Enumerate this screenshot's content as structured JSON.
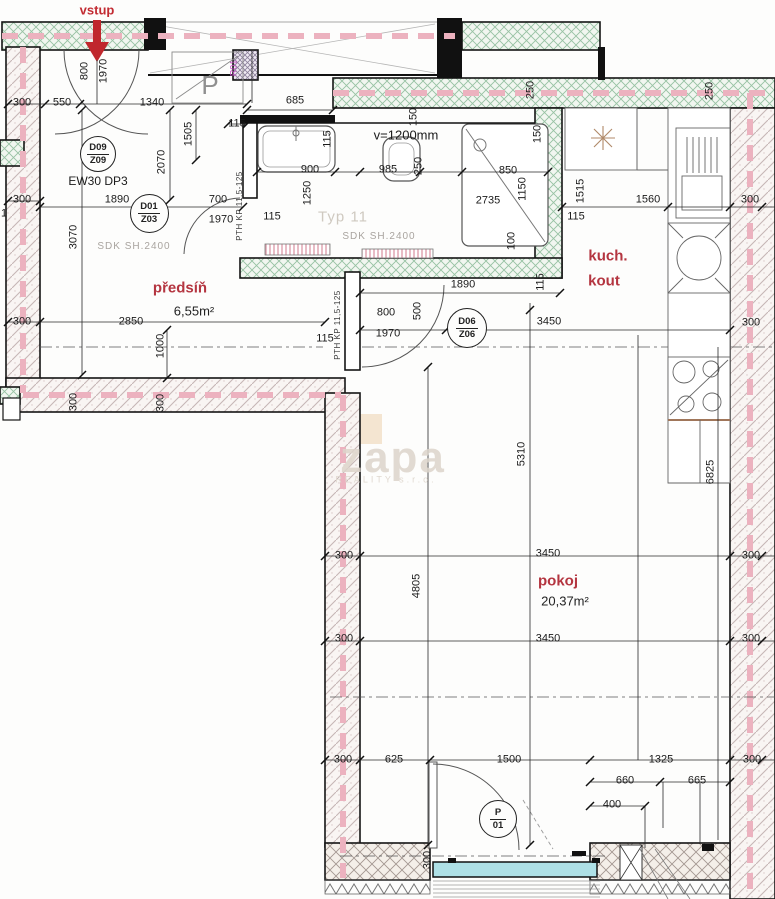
{
  "drawing_labels": {
    "entrance": "vstup",
    "watermark": "zapa",
    "watermark_sub": "REALITY s.r.o."
  },
  "rooms": [
    {
      "name": "předsíň",
      "area": "6,55m²"
    },
    {
      "name": "koupelna",
      "area": "3,22m²"
    },
    {
      "name": "kuch. kout",
      "area": ""
    },
    {
      "name": "pokoj",
      "area": "20,37m²"
    }
  ],
  "door_tags": [
    {
      "line1": "D09",
      "line2": "Z09",
      "x": 97,
      "y": 153,
      "d": 34
    },
    {
      "line1": "D01",
      "line2": "Z03",
      "x": 148,
      "y": 212,
      "d": 37
    },
    {
      "line1": "D06",
      "line2": "Z06",
      "x": 466,
      "y": 327,
      "d": 38
    },
    {
      "line1": "P",
      "line2": "01",
      "x": 497,
      "y": 818,
      "d": 36
    }
  ],
  "fixtures": [
    "bathtub",
    "toilet",
    "shower",
    "kitchen-sink",
    "dish-rack",
    "stove",
    "wardrobe",
    "radiator",
    "balcony-door",
    "entrance-arrow"
  ],
  "colors": {
    "room_label_red": "#b43540",
    "entrance_red": "#c22b32",
    "pink_dash": "#ecb2bf",
    "green_hatch": "#97c2a3",
    "glass_cyan": "#aee0e6",
    "watermark": "#ddd5cb"
  },
  "annotations": [
    {
      "t": "vstup",
      "x": 97,
      "y": 10,
      "c": "red"
    },
    {
      "t": "800",
      "x": 85,
      "y": 71,
      "r": -90
    },
    {
      "t": "1970",
      "x": 104,
      "y": 71,
      "r": -90
    },
    {
      "t": "300",
      "x": 22,
      "y": 103
    },
    {
      "t": "550",
      "x": 62,
      "y": 103
    },
    {
      "t": "1340",
      "x": 152,
      "y": 103
    },
    {
      "t": "685",
      "x": 295,
      "y": 101
    },
    {
      "t": "115",
      "x": 237,
      "y": 124
    },
    {
      "t": "300",
      "x": 22,
      "y": 200
    },
    {
      "t": "1890",
      "x": 117,
      "y": 200
    },
    {
      "t": "700",
      "x": 218,
      "y": 200
    },
    {
      "t": "1970",
      "x": 221,
      "y": 220
    },
    {
      "t": "2070",
      "x": 162,
      "y": 162,
      "r": -90
    },
    {
      "t": "1505",
      "x": 189,
      "y": 134,
      "r": -90
    },
    {
      "t": "3070",
      "x": 74,
      "y": 237,
      "r": -90
    },
    {
      "t": "EW30 DP3",
      "x": 98,
      "y": 181,
      "c": "s12"
    },
    {
      "t": "SDK SH.2400",
      "x": 134,
      "y": 247,
      "c": "gray"
    },
    {
      "t": "R01",
      "x": 234,
      "y": 68,
      "r": -90,
      "c": "mag"
    },
    {
      "t": "P",
      "x": 210,
      "y": 85,
      "c": "pbig"
    },
    {
      "t": "PTH KP 11,5-125",
      "x": 240,
      "y": 206,
      "r": -90,
      "c": "mat"
    },
    {
      "t": "1250",
      "x": 308,
      "y": 193,
      "r": -90
    },
    {
      "t": "115",
      "x": 328,
      "y": 139,
      "r": -90
    },
    {
      "t": "900",
      "x": 310,
      "y": 170
    },
    {
      "t": "115",
      "x": 272,
      "y": 217
    },
    {
      "t": "v=1200mm",
      "x": 406,
      "y": 135,
      "c": "s13"
    },
    {
      "t": "985",
      "x": 388,
      "y": 170
    },
    {
      "t": "150",
      "x": 414,
      "y": 117,
      "r": -90
    },
    {
      "t": "250",
      "x": 419,
      "y": 166,
      "r": -90
    },
    {
      "t": "850",
      "x": 508,
      "y": 171
    },
    {
      "t": "2735",
      "x": 488,
      "y": 201
    },
    {
      "t": "1150",
      "x": 523,
      "y": 189,
      "r": -90
    },
    {
      "t": "250",
      "x": 531,
      "y": 90,
      "r": -90
    },
    {
      "t": "150",
      "x": 538,
      "y": 134,
      "r": -90
    },
    {
      "t": "100",
      "x": 512,
      "y": 241,
      "r": -90
    },
    {
      "t": "115",
      "x": 541,
      "y": 282,
      "r": -90
    },
    {
      "t": "Typ 11",
      "x": 343,
      "y": 217,
      "c": "faint"
    },
    {
      "t": "SDK SH.2400",
      "x": 379,
      "y": 237,
      "c": "gray"
    },
    {
      "t": "250",
      "x": 710,
      "y": 91,
      "r": -90
    },
    {
      "t": "1515",
      "x": 581,
      "y": 191,
      "r": -90
    },
    {
      "t": "1560",
      "x": 648,
      "y": 200
    },
    {
      "t": "115",
      "x": 576,
      "y": 217
    },
    {
      "t": "300",
      "x": 750,
      "y": 200
    },
    {
      "t": "kuch.",
      "x": 608,
      "y": 256,
      "c": "room"
    },
    {
      "t": "kout",
      "x": 604,
      "y": 281,
      "c": "room"
    },
    {
      "t": "1890",
      "x": 463,
      "y": 285
    },
    {
      "t": "800",
      "x": 386,
      "y": 313
    },
    {
      "t": "1970",
      "x": 388,
      "y": 334
    },
    {
      "t": "500",
      "x": 418,
      "y": 311,
      "r": -90
    },
    {
      "t": "3450",
      "x": 549,
      "y": 322
    },
    {
      "t": "300",
      "x": 751,
      "y": 323
    },
    {
      "t": "115",
      "x": 325,
      "y": 339
    },
    {
      "t": "PTH KP 11,5-125",
      "x": 338,
      "y": 325,
      "r": -90,
      "c": "mat"
    },
    {
      "t": "předsíň",
      "x": 180,
      "y": 288,
      "c": "room"
    },
    {
      "t": "6,55m²",
      "x": 194,
      "y": 311,
      "c": "area"
    },
    {
      "t": "2850",
      "x": 131,
      "y": 322
    },
    {
      "t": "300",
      "x": 22,
      "y": 322
    },
    {
      "t": "1000",
      "x": 161,
      "y": 346,
      "r": -90
    },
    {
      "t": "1",
      "x": 4,
      "y": 214
    },
    {
      "t": "300",
      "x": 74,
      "y": 402,
      "r": -90
    },
    {
      "t": "300",
      "x": 161,
      "y": 403,
      "r": -90
    },
    {
      "t": "zapa",
      "x": 393,
      "y": 458,
      "c": "wm1"
    },
    {
      "t": "REALITY s.r.o.",
      "x": 386,
      "y": 480,
      "c": "wm2"
    },
    {
      "t": "5310",
      "x": 522,
      "y": 454,
      "r": -90
    },
    {
      "t": "6825",
      "x": 711,
      "y": 472,
      "r": -90
    },
    {
      "t": "3450",
      "x": 548,
      "y": 554
    },
    {
      "t": "300",
      "x": 344,
      "y": 556
    },
    {
      "t": "300",
      "x": 751,
      "y": 556
    },
    {
      "t": "4805",
      "x": 417,
      "y": 586,
      "r": -90
    },
    {
      "t": "pokoj",
      "x": 558,
      "y": 581,
      "c": "room"
    },
    {
      "t": "20,37m²",
      "x": 565,
      "y": 601,
      "c": "area"
    },
    {
      "t": "3450",
      "x": 548,
      "y": 639
    },
    {
      "t": "300",
      "x": 344,
      "y": 639
    },
    {
      "t": "300",
      "x": 751,
      "y": 639
    },
    {
      "t": "300",
      "x": 343,
      "y": 760
    },
    {
      "t": "625",
      "x": 394,
      "y": 760
    },
    {
      "t": "1500",
      "x": 509,
      "y": 760
    },
    {
      "t": "1325",
      "x": 661,
      "y": 760
    },
    {
      "t": "300",
      "x": 752,
      "y": 760
    },
    {
      "t": "660",
      "x": 625,
      "y": 781
    },
    {
      "t": "665",
      "x": 697,
      "y": 781
    },
    {
      "t": "400",
      "x": 612,
      "y": 805
    },
    {
      "t": "300",
      "x": 428,
      "y": 860,
      "r": -90
    }
  ]
}
